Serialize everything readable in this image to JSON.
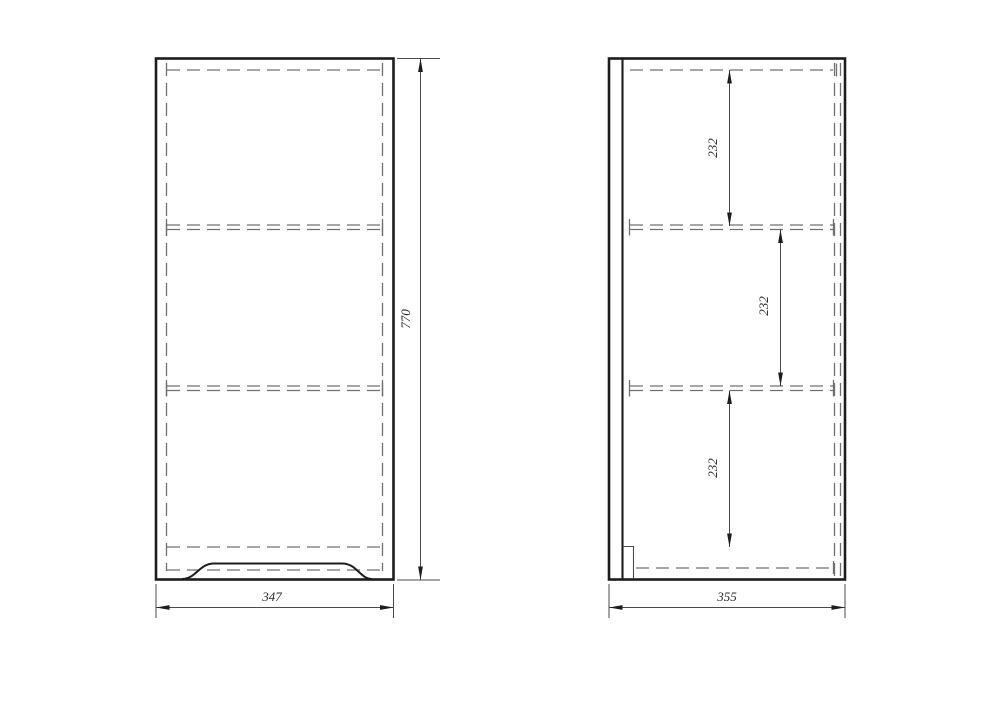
{
  "drawing": {
    "front_view": {
      "height_dimension": "770",
      "width_dimension": "347"
    },
    "side_view": {
      "top_section_dimension": "232",
      "middle_section_dimension": "232",
      "bottom_section_dimension": "232",
      "width_dimension": "355"
    },
    "colors": {
      "background": "#ffffff",
      "outline": "#1d1d1d",
      "hidden_line": "#707070",
      "dimension_line": "#4b4b4b",
      "dimension_text": "#2b2b2b"
    }
  }
}
